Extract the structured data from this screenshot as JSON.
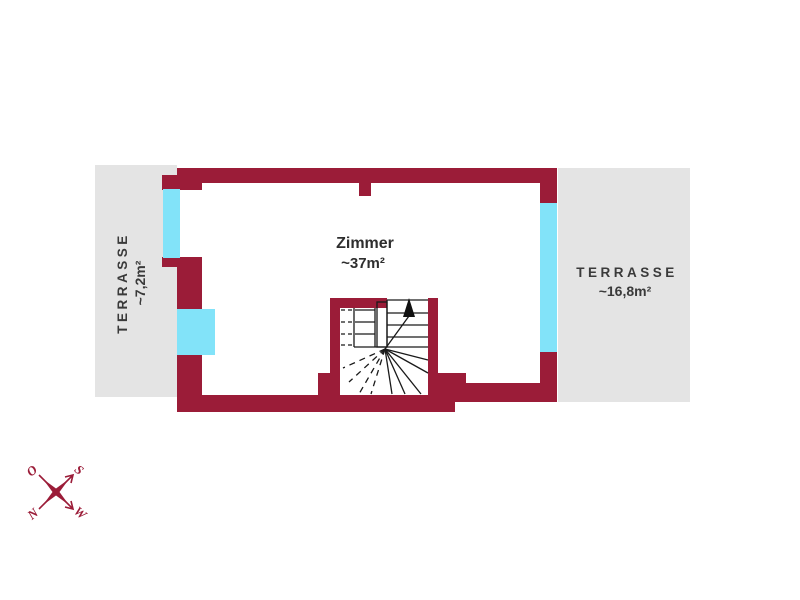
{
  "plan": {
    "room": {
      "name": "Zimmer",
      "area": "~37m²"
    },
    "terrace_left": {
      "name": "TERRASSE",
      "area": "~7,2m²"
    },
    "terrace_right": {
      "name": "TERRASSE",
      "area": "~16,8m²"
    }
  },
  "compass": {
    "o": "O",
    "s": "S",
    "n": "N",
    "w": "W"
  },
  "colors": {
    "wall": "#9B1C38",
    "window": "#82E3F9",
    "terrace": "#E4E4E4",
    "label_text": "#3A3A3A",
    "stair_lines": "#1A1A1A",
    "compass": "#9B1C38",
    "background": "#FFFFFF"
  }
}
